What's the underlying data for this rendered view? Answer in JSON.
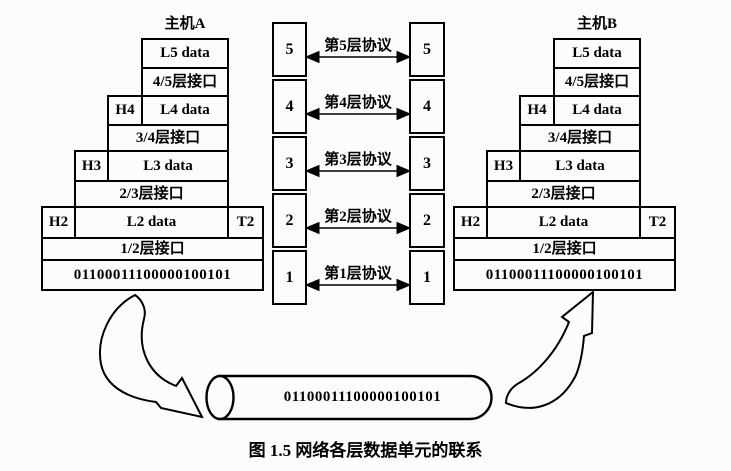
{
  "hosts": {
    "a": {
      "title": "主机A"
    },
    "b": {
      "title": "主机B"
    }
  },
  "stack": {
    "l5_data": "L5 data",
    "interface_4_5": "4/5层接口",
    "h4": "H4",
    "l4_data": "L4 data",
    "interface_3_4": "3/4层接口",
    "h3": "H3",
    "l3_data": "L3 data",
    "interface_2_3": "2/3层接口",
    "h2": "H2",
    "l2_data": "L2 data",
    "t2": "T2",
    "interface_1_2": "1/2层接口",
    "bitstream": "01100011100000100101"
  },
  "protocol_columns": {
    "layers": [
      {
        "number": "5",
        "label": "第5层协议"
      },
      {
        "number": "4",
        "label": "第4层协议"
      },
      {
        "number": "3",
        "label": "第3层协议"
      },
      {
        "number": "2",
        "label": "第2层协议"
      },
      {
        "number": "1",
        "label": "第1层协议"
      }
    ]
  },
  "channel": {
    "bitstream": "01100011100000100101"
  },
  "caption": {
    "text": "图 1.5  网络各层数据单元的联系"
  },
  "colors": {
    "line": "#000000",
    "background": "#fcfcfc"
  }
}
